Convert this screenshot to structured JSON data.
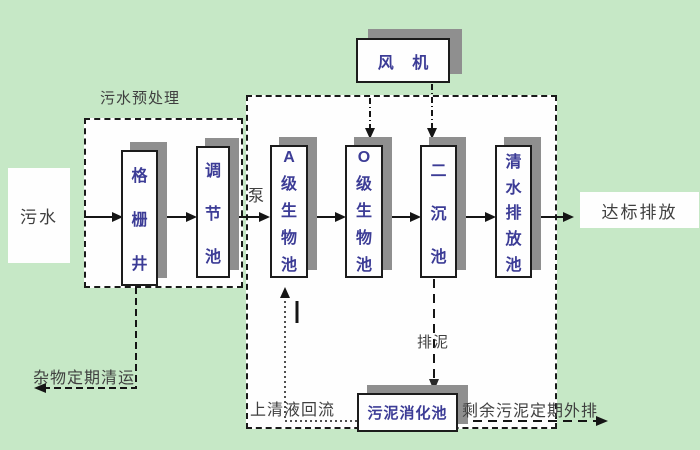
{
  "colors": {
    "background": "#c6e8c6",
    "region_fill": "#fefefe",
    "box_border": "#1c1c1c",
    "box_shadow": "#8f8f8f",
    "box_text": "#3c3c96",
    "label_text": "#3f3f3f"
  },
  "regions": {
    "pretreatment_label": "污水预处理"
  },
  "boxes": {
    "grid_well": "格栅井",
    "regulating_tank": "调节池",
    "a_bio_tank": "A级生物池",
    "o_bio_tank": "O级生物池",
    "secondary_clarifier": "二沉池",
    "clean_water_tank": "清水排放池",
    "fan": "风 机",
    "sludge_digester": "污泥消化池"
  },
  "endpoints": {
    "influent": "污水",
    "effluent": "达标排放"
  },
  "flow_labels": {
    "pump": "泵",
    "debris_removal": "杂物定期清运",
    "supernatant_return": "上清液回流",
    "sludge_discharge": "排泥",
    "excess_sludge_out": "剩余污泥定期外排"
  }
}
